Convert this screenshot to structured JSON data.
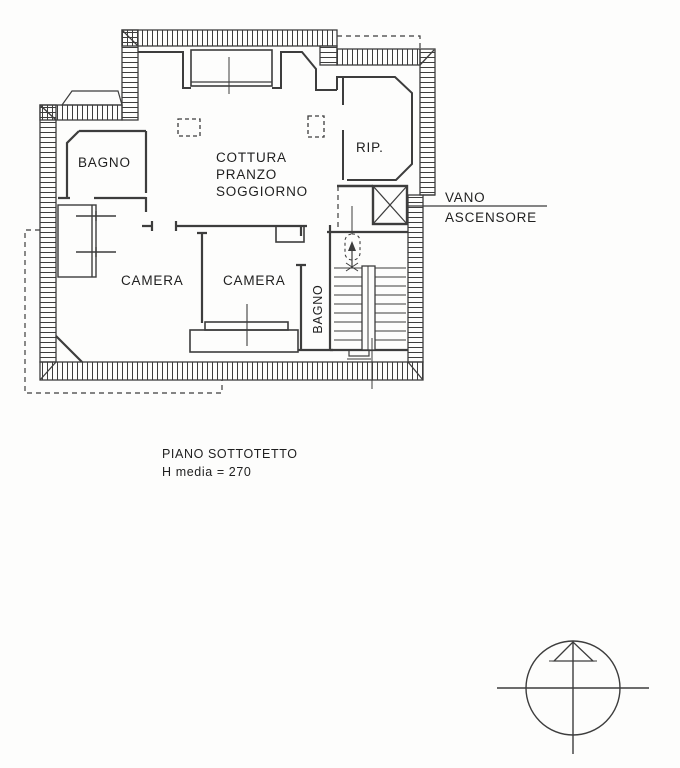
{
  "document": {
    "type": "architectural-floor-plan",
    "floor_caption": {
      "line1": "PIANO SOTTOTETTO",
      "line2": "H media = 270"
    },
    "colors": {
      "line": "#3d3d3d",
      "text": "#1f1f1f",
      "paper": "#fdfdfc"
    }
  },
  "plan": {
    "rooms": [
      {
        "id": "bagno-1",
        "label": "BAGNO"
      },
      {
        "id": "living",
        "label_lines": [
          "COTTURA",
          "PRANZO",
          "SOGGIORNO"
        ]
      },
      {
        "id": "rip",
        "label": "RIP."
      },
      {
        "id": "camera-1",
        "label": "CAMERA"
      },
      {
        "id": "camera-2",
        "label": "CAMERA"
      },
      {
        "id": "bagno-2",
        "label": "BAGNO"
      }
    ],
    "annotations": {
      "elevator_line1": "VANO",
      "elevator_line2": "ASCENSORE"
    },
    "symbols": [
      {
        "id": "elevator-shaft",
        "meaning": "lift shaft with X cross"
      },
      {
        "id": "staircase",
        "meaning": "stair run with up arrow"
      },
      {
        "id": "north-compass",
        "meaning": "orientation compass with north arrow"
      }
    ]
  }
}
